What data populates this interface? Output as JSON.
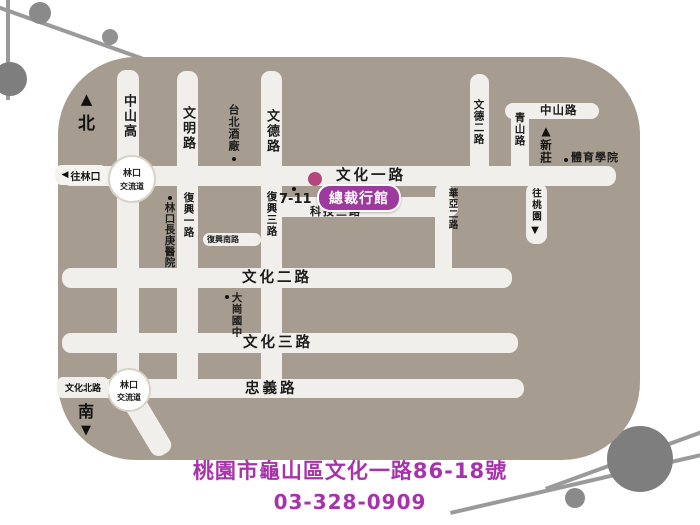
{
  "map": {
    "compass_north": "北",
    "compass_south": "南",
    "roads": {
      "wenhua1": "文化一路",
      "keji3": "科技三路",
      "fuxing_south": "復興南路",
      "wenhua2": "文化二路",
      "wenhua3": "文化三路",
      "zhongyi": "忠義路",
      "wenhua_north": "文化北路",
      "zhongshan_rd": "中山路",
      "zhongshan_hwy": "中山高",
      "wenming": "文明路",
      "fuxing1": "復興一路",
      "wende": "文德路",
      "fuxing3": "復興三路",
      "wende2": "文德二路",
      "qingshan": "青山路",
      "huaya2": "華亞二路"
    },
    "interchange": {
      "line1": "林口",
      "line2": "交流道"
    },
    "directions": {
      "to_linkou": "往林口",
      "to_taoyuan": "往桃園",
      "to_xinzhuang": "新莊"
    },
    "landmarks": {
      "taipei_brewery": "台北酒廠",
      "changgung_hospital": "林口長庚醫院",
      "seven_eleven": "7-11",
      "sports_college": "體育學院",
      "dagang_school": "大崗國中"
    },
    "venue": {
      "name": "總裁行館"
    }
  },
  "icons": {
    "north_arrow": "▲",
    "south_arrow": "▼",
    "left_arrow": "◀",
    "up_arrow": "▲",
    "down_arrow": "▼"
  },
  "footer": {
    "address": "桃園市龜山區文化一路86-18號",
    "phone": "03-328-0909"
  },
  "colors": {
    "map_bg": "#a69d90",
    "road": "#f1efeb",
    "badge": "#9d3a9d",
    "venue_dot": "#b4487e",
    "accent_text": "#a733ab",
    "decor_gray": "#8a8a8a"
  }
}
